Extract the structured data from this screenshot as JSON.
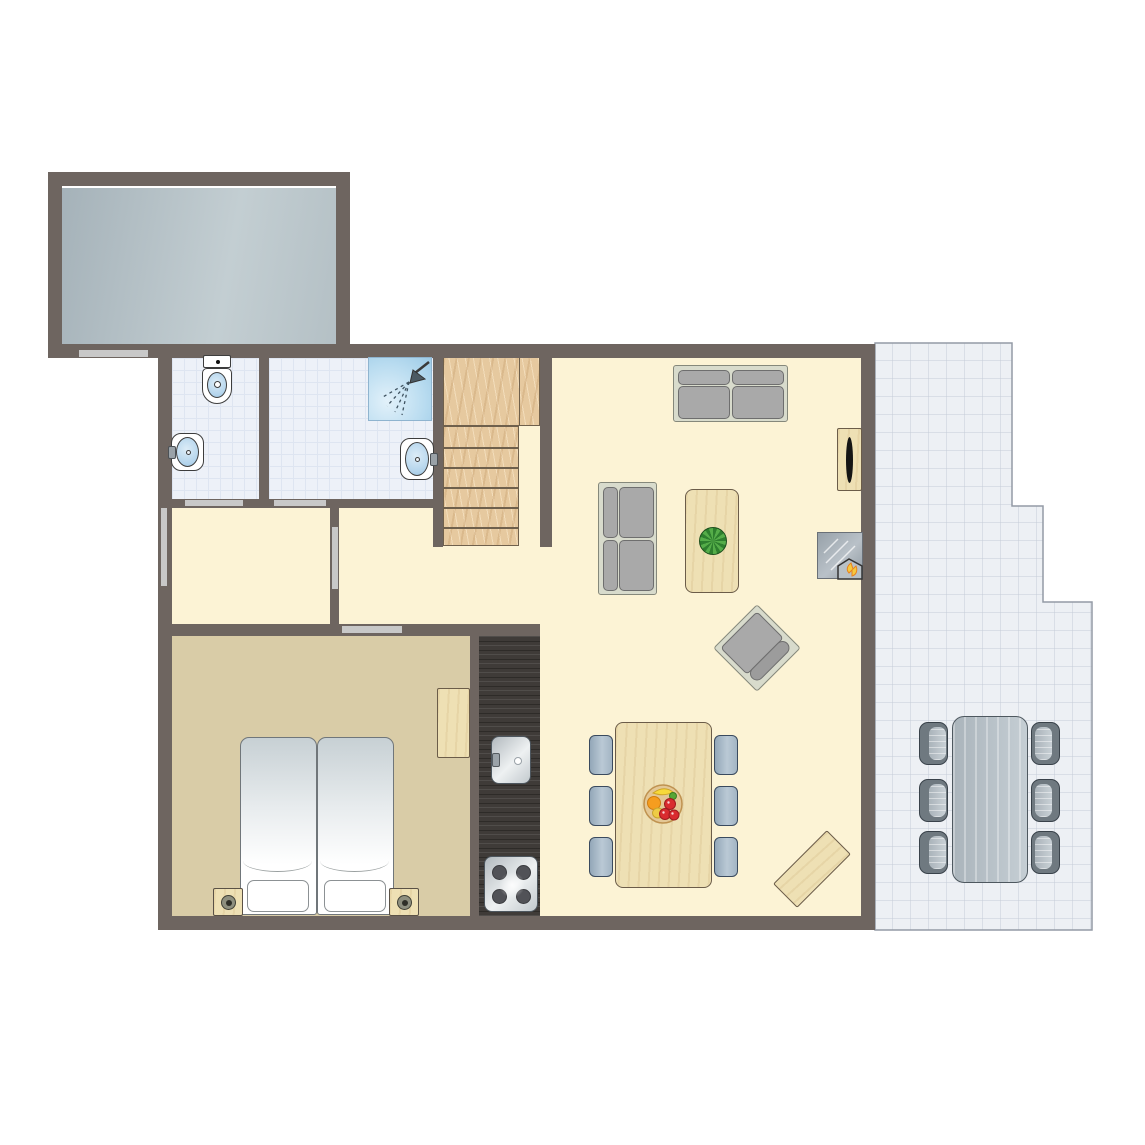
{
  "title": "apartment-floor-plan",
  "canvas": {
    "width": 1145,
    "height": 1145,
    "background": "#ffffff"
  },
  "palette": {
    "wall": "#6e6560",
    "door": "#c8c8c8",
    "floorCream": "#fcf3d5",
    "floorBedroom": "#d9cca7",
    "bath": "#edf1f8",
    "bathGrid": "#dee5f1",
    "kitchenDark": "#3f3b38",
    "storageA": "#a5b2b9",
    "storageB": "#c3ced2",
    "woodStairs": "#e6c99f",
    "woodLight": "#eee0b4",
    "sofaFrame": "#d8dbcc",
    "cushion": "#a9a9a9",
    "cushionEdge": "#6e6e6e",
    "terraceFill": "#edf0f4",
    "terraceGrid": "#c5ccd7",
    "terraceEdge": "#949aa5",
    "canvasBg": "#ffffff"
  },
  "rooms": [
    {
      "id": "storage-room-floor",
      "floor": "storage",
      "x": 62,
      "y": 188,
      "w": 274,
      "h": 156
    },
    {
      "id": "living-area-floor",
      "floor": "cream",
      "x": 172,
      "y": 358,
      "w": 689,
      "h": 558
    },
    {
      "id": "wc-floor",
      "floor": "bath",
      "x": 172,
      "y": 358,
      "w": 87,
      "h": 141
    },
    {
      "id": "shower-room-floor",
      "floor": "bath",
      "x": 269,
      "y": 358,
      "w": 164,
      "h": 141
    },
    {
      "id": "bedroom-floor",
      "floor": "bedroom",
      "x": 172,
      "y": 636,
      "w": 298,
      "h": 281
    },
    {
      "id": "kitchen-counter",
      "floor": "kitchen",
      "x": 479,
      "y": 636,
      "w": 61,
      "h": 281
    }
  ],
  "terrace": {
    "id": "terrace-floor",
    "x": 874,
    "y": 342,
    "w": 220,
    "h": 590,
    "tile": 18,
    "points": [
      [
        1,
        1
      ],
      [
        138,
        1
      ],
      [
        138,
        164
      ],
      [
        169,
        164
      ],
      [
        169,
        260
      ],
      [
        218,
        260
      ],
      [
        218,
        588
      ],
      [
        1,
        588
      ]
    ]
  },
  "walls": [
    [
      48,
      172,
      302,
      14
    ],
    [
      48,
      172,
      14,
      186
    ],
    [
      336,
      172,
      14,
      186
    ],
    [
      48,
      344,
      827,
      14
    ],
    [
      158,
      344,
      14,
      586
    ],
    [
      861,
      344,
      14,
      586
    ],
    [
      158,
      916,
      717,
      14
    ],
    [
      259,
      358,
      10,
      141
    ],
    [
      433,
      358,
      10,
      189
    ],
    [
      169,
      499,
      274,
      9
    ],
    [
      330,
      508,
      9,
      116
    ],
    [
      172,
      624,
      368,
      12
    ],
    [
      470,
      636,
      9,
      280
    ],
    [
      540,
      344,
      12,
      203
    ]
  ],
  "doors": [
    [
      79,
      350,
      69,
      7
    ],
    [
      185,
      500,
      58,
      6
    ],
    [
      274,
      500,
      52,
      6
    ],
    [
      161,
      508,
      6,
      78
    ],
    [
      332,
      527,
      6,
      62
    ],
    [
      342,
      626,
      60,
      7
    ]
  ],
  "stairs": {
    "x": 443,
    "y": 354,
    "landingW": 97,
    "landingH": 72,
    "stepsW": 76,
    "stepsH": 120,
    "treads": 6
  },
  "furniture": [
    {
      "id": "sofa-large",
      "kind": "sofa",
      "x": 673,
      "y": 365,
      "w": 115,
      "h": 57,
      "back": "top"
    },
    {
      "id": "sofa-small",
      "kind": "sofa",
      "x": 598,
      "y": 482,
      "w": 59,
      "h": 113,
      "back": "left"
    },
    {
      "id": "coffee-table",
      "kind": "wood-table",
      "x": 685,
      "y": 489,
      "w": 54,
      "h": 104,
      "plant": {
        "cx": 27,
        "cy": 51,
        "r": 14
      }
    },
    {
      "id": "tv-cabinet",
      "kind": "tv-cabinet",
      "x": 837,
      "y": 428,
      "w": 25,
      "h": 63
    },
    {
      "id": "fireplace",
      "kind": "fireplace",
      "x": 817,
      "y": 532,
      "w": 46,
      "h": 47
    },
    {
      "id": "lounge-chair",
      "kind": "lounger",
      "cx": 757,
      "cy": 648,
      "w": 62,
      "h": 62,
      "angle": 45
    },
    {
      "id": "dining-table",
      "kind": "wood-table",
      "x": 615,
      "y": 722,
      "w": 97,
      "h": 166,
      "fruit": {
        "cx": 47,
        "cy": 81,
        "r": 20
      }
    },
    {
      "id": "dining-chair-1",
      "kind": "chair",
      "x": 589,
      "y": 735,
      "w": 24,
      "h": 40
    },
    {
      "id": "dining-chair-2",
      "kind": "chair",
      "x": 589,
      "y": 786,
      "w": 24,
      "h": 40
    },
    {
      "id": "dining-chair-3",
      "kind": "chair",
      "x": 589,
      "y": 837,
      "w": 24,
      "h": 40
    },
    {
      "id": "dining-chair-4",
      "kind": "chair",
      "x": 714,
      "y": 735,
      "w": 24,
      "h": 40
    },
    {
      "id": "dining-chair-5",
      "kind": "chair",
      "x": 714,
      "y": 786,
      "w": 24,
      "h": 40
    },
    {
      "id": "dining-chair-6",
      "kind": "chair",
      "x": 714,
      "y": 837,
      "w": 24,
      "h": 40
    },
    {
      "id": "side-bench",
      "kind": "bench",
      "cx": 812,
      "cy": 869,
      "w": 34,
      "h": 76,
      "angle": 45
    },
    {
      "id": "patio-table",
      "kind": "patio-table",
      "x": 952,
      "y": 716,
      "w": 76,
      "h": 167
    },
    {
      "id": "patio-chair-1",
      "kind": "patio-chair",
      "x": 919,
      "y": 722,
      "w": 29,
      "h": 43,
      "side": "right"
    },
    {
      "id": "patio-chair-2",
      "kind": "patio-chair",
      "x": 919,
      "y": 779,
      "w": 29,
      "h": 43,
      "side": "right"
    },
    {
      "id": "patio-chair-3",
      "kind": "patio-chair",
      "x": 919,
      "y": 831,
      "w": 29,
      "h": 43,
      "side": "right"
    },
    {
      "id": "patio-chair-4",
      "kind": "patio-chair",
      "x": 1031,
      "y": 722,
      "w": 29,
      "h": 43,
      "side": "left"
    },
    {
      "id": "patio-chair-5",
      "kind": "patio-chair",
      "x": 1031,
      "y": 779,
      "w": 29,
      "h": 43,
      "side": "left"
    },
    {
      "id": "patio-chair-6",
      "kind": "patio-chair",
      "x": 1031,
      "y": 831,
      "w": 29,
      "h": 43,
      "side": "left"
    },
    {
      "id": "bed-left",
      "kind": "bed",
      "x": 240,
      "y": 737,
      "w": 77,
      "h": 178
    },
    {
      "id": "bed-right",
      "kind": "bed",
      "x": 317,
      "y": 737,
      "w": 77,
      "h": 178
    },
    {
      "id": "nightstand-left",
      "kind": "nightstand",
      "x": 213,
      "y": 888,
      "w": 30,
      "h": 28
    },
    {
      "id": "nightstand-right",
      "kind": "nightstand",
      "x": 389,
      "y": 888,
      "w": 30,
      "h": 28
    },
    {
      "id": "wardrobe",
      "kind": "wood-block",
      "x": 437,
      "y": 688,
      "w": 33,
      "h": 70
    },
    {
      "id": "kitchen-sink",
      "kind": "ksink",
      "x": 491,
      "y": 736,
      "w": 40,
      "h": 48
    },
    {
      "id": "stove",
      "kind": "stove",
      "x": 484,
      "y": 856,
      "w": 54,
      "h": 56
    },
    {
      "id": "toilet",
      "kind": "toilet",
      "x": 202,
      "y": 355,
      "w": 30,
      "h": 49
    },
    {
      "id": "wc-sink",
      "kind": "sink",
      "x": 171,
      "y": 433,
      "w": 33,
      "h": 38,
      "tap": "left"
    },
    {
      "id": "shower",
      "kind": "shower",
      "x": 368,
      "y": 357,
      "w": 64,
      "h": 64
    },
    {
      "id": "shower-sink",
      "kind": "sink",
      "x": 400,
      "y": 438,
      "w": 34,
      "h": 42,
      "tap": "right"
    }
  ]
}
